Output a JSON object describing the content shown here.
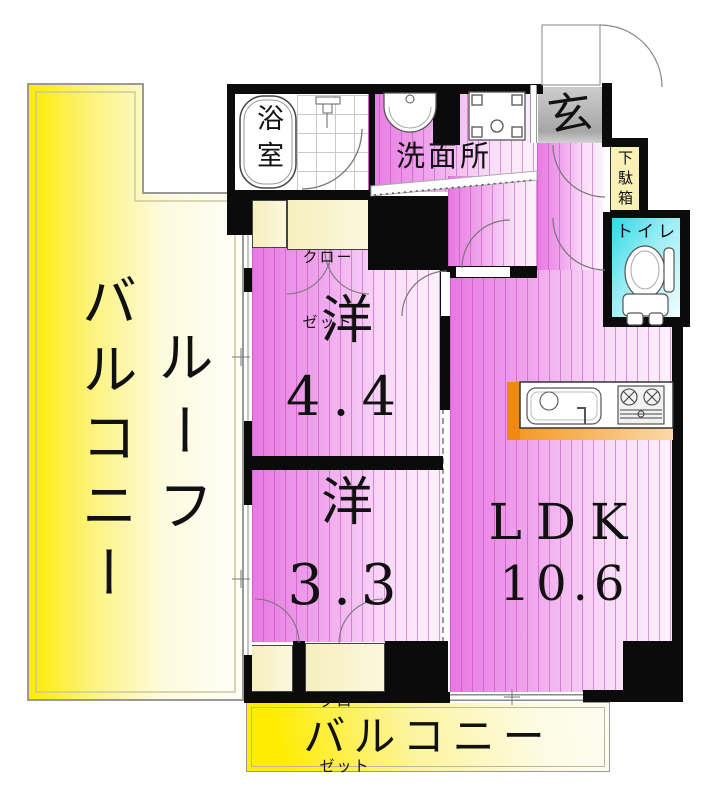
{
  "rooms": {
    "roof_balcony": {
      "label_col_inner": "ルーフ",
      "label_col_outer": "バルコニー"
    },
    "balcony": {
      "label": "バルコニー"
    },
    "western_4_4": {
      "label": "洋",
      "size": "4.4"
    },
    "western_3_3": {
      "label": "洋",
      "size": "3.3"
    },
    "ldk": {
      "label": "LDK",
      "size": "10.6"
    },
    "bathroom": {
      "label": "浴室"
    },
    "washroom": {
      "label": "洗面所"
    },
    "entrance": {
      "label": "玄"
    },
    "shoe_cabinet": {
      "label": "下駄箱"
    },
    "toilet": {
      "label": "トイレ"
    },
    "closet_upper": {
      "label_line1": "クロー",
      "label_line2": "ゼット"
    },
    "closet_lower": {
      "label_line1": "クロー",
      "label_line2": "ゼット"
    }
  },
  "colors": {
    "room_pink": "#ee82e8",
    "balcony_yellow": "#ffec00",
    "toilet_cyan": "#2fd8e6",
    "kitchen_orange": "#f5941e",
    "closet_cream": "#f6efbe",
    "entrance_gray": "#b0b0b0",
    "wall_black": "#0b0b0b"
  }
}
